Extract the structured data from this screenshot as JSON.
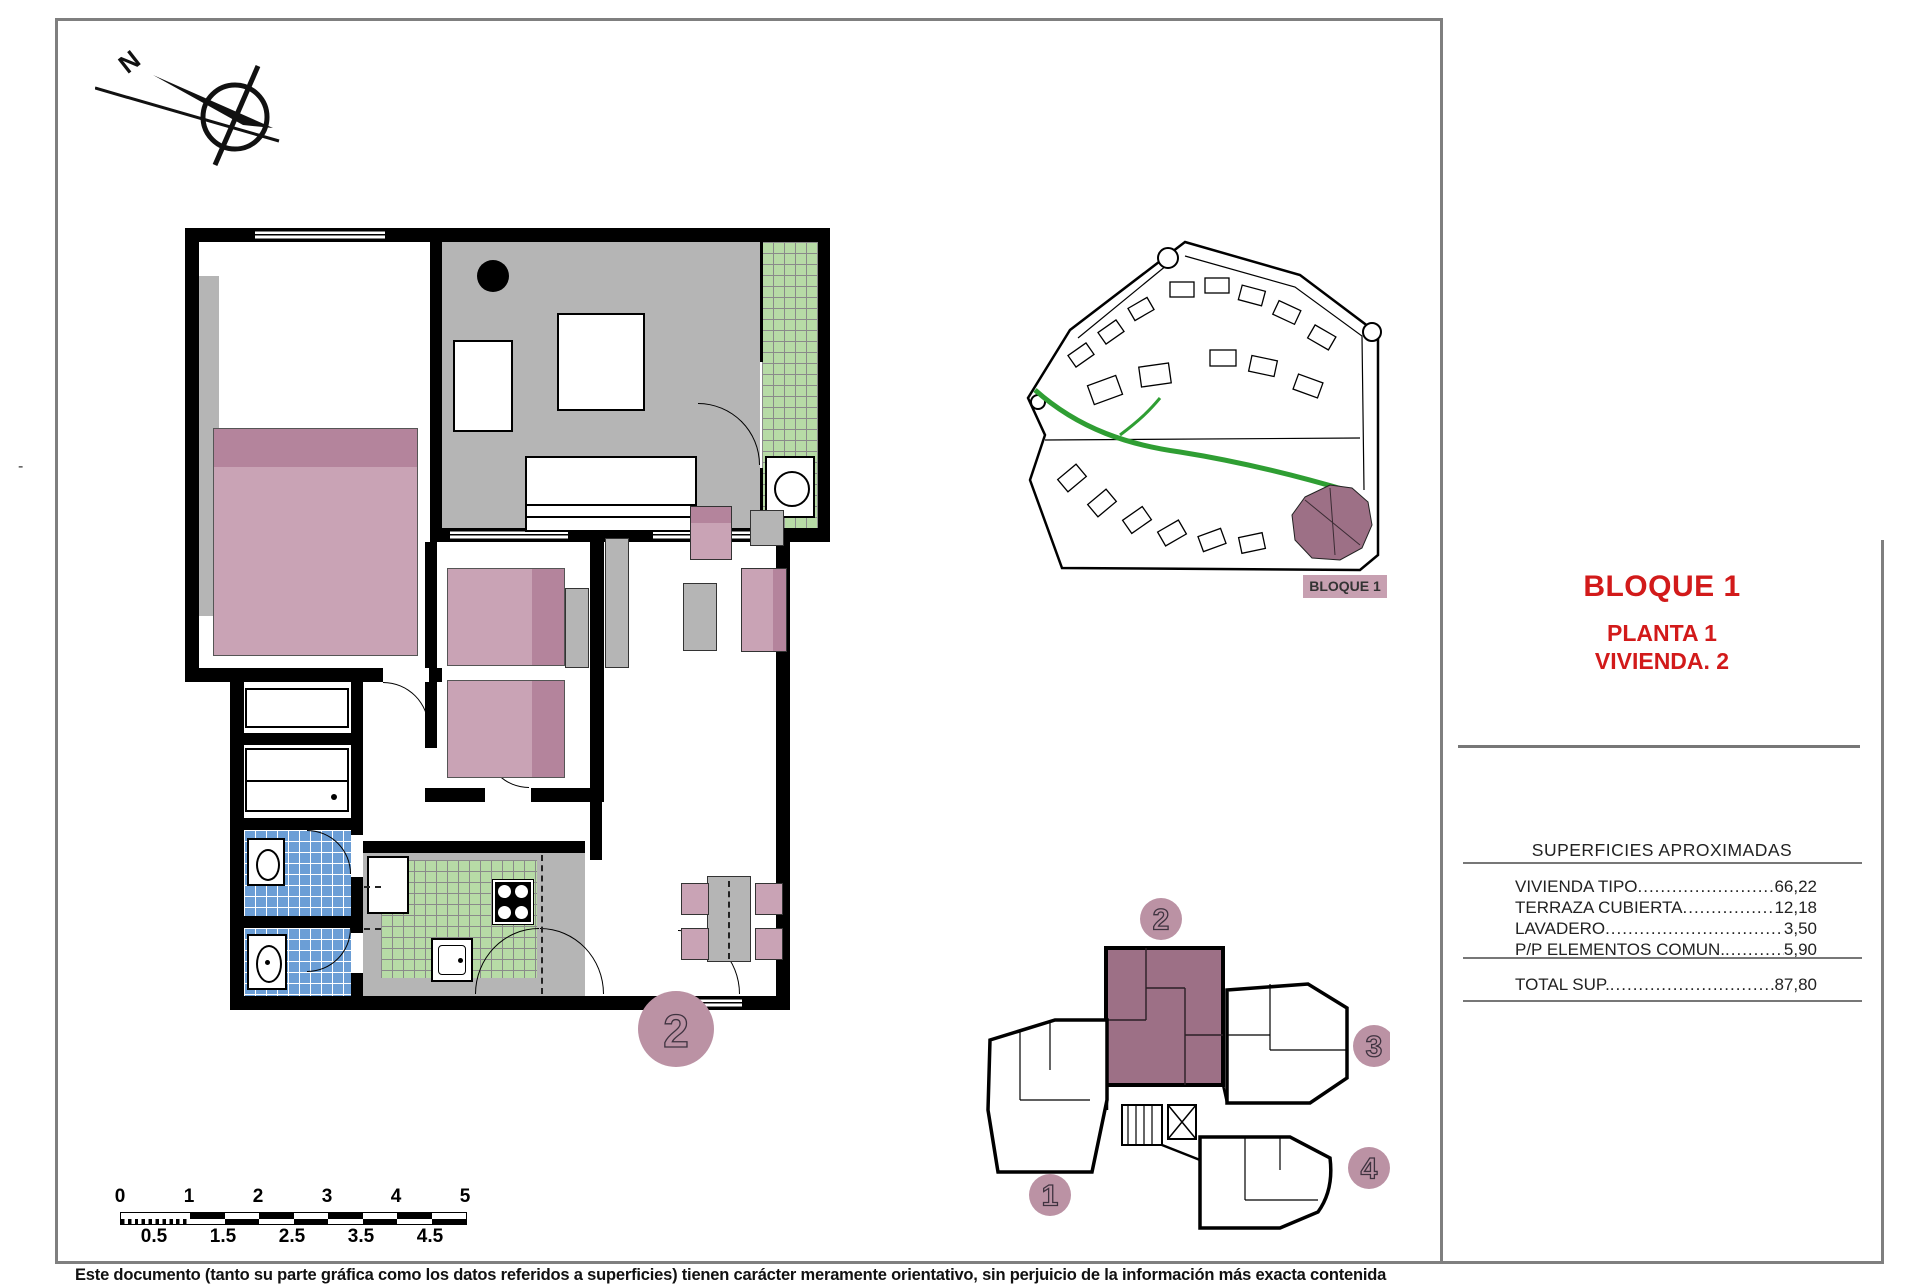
{
  "compass": {
    "north_label": "N"
  },
  "title_block": {
    "title": "BLOQUE 1",
    "subtitle1": "PLANTA 1",
    "subtitle2": "VIVIENDA. 2"
  },
  "surfaces_table": {
    "header": "SUPERFICIES APROXIMADAS",
    "rows": [
      {
        "label": "VIVIENDA TIPO",
        "value": "66,22"
      },
      {
        "label": "TERRAZA CUBIERTA",
        "value": "12,18"
      },
      {
        "label": "LAVADERO",
        "value": "3,50"
      },
      {
        "label": "P/P ELEMENTOS COMUN.",
        "value": "5,90"
      }
    ],
    "total": {
      "label": "TOTAL SUP.",
      "value": "87,80"
    }
  },
  "site_plan": {
    "label": "BLOQUE 1"
  },
  "key_plan": {
    "units": [
      "1",
      "2",
      "3",
      "4"
    ],
    "highlighted_unit": "2"
  },
  "main_plan": {
    "unit_number": "2"
  },
  "scale_bar": {
    "major_labels": [
      "0",
      "1",
      "2",
      "3",
      "4",
      "5"
    ],
    "minor_labels": [
      "0.5",
      "1.5",
      "2.5",
      "3.5",
      "4.5"
    ]
  },
  "footer": {
    "disclaimer": "Este documento (tanto su parte gráfica como los datos referidos a superficies) tienen carácter meramente orientativo, sin perjuicio de la información más exacta contenida"
  },
  "misc": {
    "margin_mark": "-"
  },
  "colors": {
    "title_red": "#d21a1a",
    "highlight_mauve": "#9d7086",
    "badge_pink": "#bb92a4",
    "furniture_pink": "#c9a3b5",
    "furniture_pink_dark": "#b4849c",
    "floor_gray": "#b5b5b5",
    "tile_green": "#b7dba6",
    "tile_blue": "#6b9ed6",
    "road_green": "#2f9e33",
    "wall_black": "#000000"
  }
}
